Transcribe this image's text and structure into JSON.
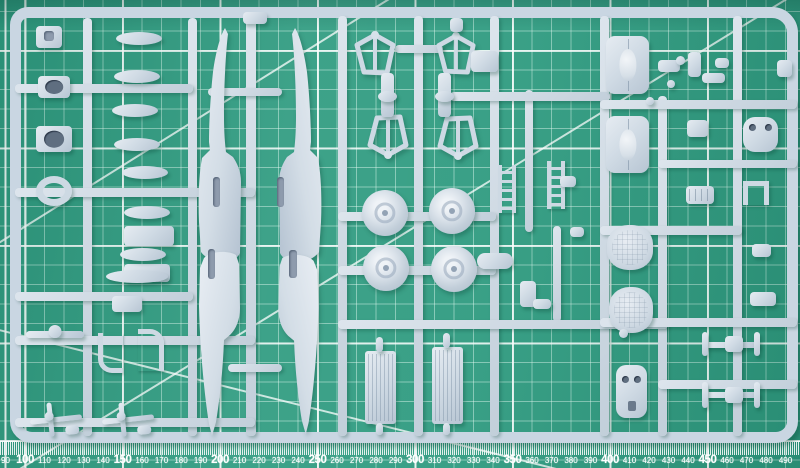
{
  "scene": {
    "subject": "model-kit-sprue-on-cutting-mat",
    "colors": {
      "mat_green": "#2f9b80",
      "grid_line": "#eafcf4",
      "plastic": "#cfdae4",
      "plastic_highlight": "#e8eef4",
      "plastic_shadow": "#9fb0c0",
      "ruler_text": "#ffffff"
    }
  },
  "ruler": {
    "unit": "mm",
    "values": [
      90,
      100,
      110,
      120,
      130,
      140,
      150,
      160,
      170,
      180,
      190,
      200,
      210,
      220,
      230,
      240,
      250,
      260,
      270,
      280,
      290,
      300,
      310,
      320,
      330,
      340,
      350,
      360,
      370,
      380,
      390,
      400,
      410,
      420,
      430,
      440,
      450,
      460,
      470,
      480,
      490
    ],
    "major_step": 50
  },
  "mat": {
    "diagonals": [
      {
        "x": 0,
        "y": 480,
        "len": 940,
        "rot": -31.5
      },
      {
        "x": -8,
        "y": 246,
        "len": 470,
        "rot": -32
      },
      {
        "x": -5,
        "y": 328,
        "len": 580,
        "rot": 14
      }
    ]
  },
  "sprue": {
    "runners_v": [
      [
        83,
        18,
        9,
        418
      ],
      [
        188,
        18,
        9,
        418
      ],
      [
        246,
        14,
        10,
        422
      ],
      [
        338,
        16,
        9,
        420
      ],
      [
        414,
        16,
        9,
        420
      ],
      [
        490,
        16,
        9,
        420
      ],
      [
        600,
        16,
        9,
        420
      ],
      [
        658,
        96,
        9,
        340
      ],
      [
        733,
        16,
        9,
        420
      ],
      [
        525,
        90,
        8,
        142
      ],
      [
        553,
        226,
        8,
        96
      ]
    ],
    "runners_h": [
      [
        15,
        84,
        178,
        9
      ],
      [
        15,
        188,
        240,
        9
      ],
      [
        15,
        292,
        178,
        9
      ],
      [
        15,
        336,
        240,
        9
      ],
      [
        15,
        418,
        240,
        9
      ],
      [
        395,
        45,
        48,
        8
      ],
      [
        450,
        92,
        160,
        9
      ],
      [
        338,
        212,
        158,
        9
      ],
      [
        338,
        266,
        158,
        9
      ],
      [
        338,
        320,
        330,
        9
      ],
      [
        600,
        100,
        197,
        9
      ],
      [
        658,
        160,
        139,
        8
      ],
      [
        600,
        226,
        142,
        9
      ],
      [
        600,
        318,
        197,
        9
      ],
      [
        658,
        380,
        139,
        9
      ],
      [
        208,
        88,
        74,
        8
      ],
      [
        228,
        364,
        54,
        8
      ]
    ],
    "parts": [
      {
        "n": "pilot-seat",
        "t": "slotrect",
        "x": 36,
        "y": 26,
        "w": 26,
        "h": 22
      },
      {
        "n": "ring-mount-1",
        "t": "holes1",
        "x": 38,
        "y": 76,
        "w": 32,
        "h": 22
      },
      {
        "n": "ring-mount-2",
        "t": "holes1",
        "x": 36,
        "y": 126,
        "w": 36,
        "h": 26
      },
      {
        "n": "gun-ring",
        "t": "ring",
        "x": 36,
        "y": 176,
        "w": 36,
        "h": 30
      },
      {
        "n": "block-1",
        "t": "rrect",
        "x": 124,
        "y": 226,
        "w": 50,
        "h": 20
      },
      {
        "n": "block-2",
        "t": "rrect",
        "x": 124,
        "y": 264,
        "w": 46,
        "h": 18
      },
      {
        "n": "anchor-part",
        "t": "rrect",
        "x": 112,
        "y": 296,
        "w": 30,
        "h": 16
      },
      {
        "n": "bomb-1",
        "t": "ellipse",
        "x": 116,
        "y": 32,
        "w": 46,
        "h": 13
      },
      {
        "n": "bomb-2",
        "t": "ellipse",
        "x": 114,
        "y": 70,
        "w": 46,
        "h": 13
      },
      {
        "n": "bomb-3",
        "t": "ellipse",
        "x": 112,
        "y": 104,
        "w": 46,
        "h": 13
      },
      {
        "n": "bomb-4",
        "t": "ellipse",
        "x": 114,
        "y": 138,
        "w": 46,
        "h": 13
      },
      {
        "n": "bomb-5",
        "t": "ellipse",
        "x": 122,
        "y": 166,
        "w": 46,
        "h": 13
      },
      {
        "n": "bomb-6",
        "t": "ellipse",
        "x": 124,
        "y": 206,
        "w": 46,
        "h": 13
      },
      {
        "n": "bomb-7",
        "t": "ellipse",
        "x": 120,
        "y": 248,
        "w": 46,
        "h": 13
      },
      {
        "n": "drop-tank",
        "t": "ellipse",
        "x": 106,
        "y": 270,
        "w": 62,
        "h": 13
      },
      {
        "n": "fuselage-half-tail-up-left",
        "t": "fus",
        "v": "up",
        "x": 197,
        "y": 28,
        "w": 50,
        "h": 235
      },
      {
        "n": "fuselage-half-tail-up-right",
        "t": "fus",
        "v": "up",
        "m": 1,
        "x": 272,
        "y": 28,
        "w": 52,
        "h": 235
      },
      {
        "n": "fuselage-half-tail-down-left",
        "t": "fus",
        "v": "dn",
        "x": 197,
        "y": 250,
        "w": 50,
        "h": 195
      },
      {
        "n": "fuselage-half-tail-down-right",
        "t": "fus",
        "v": "dn",
        "m": 1,
        "x": 271,
        "y": 253,
        "w": 50,
        "h": 190
      },
      {
        "n": "cockpit-slot",
        "t": "slot",
        "x": 213,
        "y": 177,
        "w": 7,
        "h": 30
      },
      {
        "n": "cockpit-slot",
        "t": "slot",
        "x": 277,
        "y": 177,
        "w": 7,
        "h": 30
      },
      {
        "n": "cockpit-slot",
        "t": "slot",
        "x": 208,
        "y": 249,
        "w": 7,
        "h": 30
      },
      {
        "n": "cockpit-slot",
        "t": "slot",
        "x": 289,
        "y": 250,
        "w": 8,
        "h": 28
      },
      {
        "n": "strut-frame",
        "t": "kite",
        "v": "up",
        "x": 353,
        "y": 32,
        "w": 44,
        "h": 44
      },
      {
        "n": "strut-frame",
        "t": "kite",
        "v": "up",
        "x": 435,
        "y": 33,
        "w": 42,
        "h": 42
      },
      {
        "n": "strut-frame",
        "t": "kite",
        "v": "dn",
        "x": 366,
        "y": 114,
        "w": 44,
        "h": 44
      },
      {
        "n": "strut-frame",
        "t": "kite",
        "v": "dn",
        "x": 436,
        "y": 115,
        "w": 44,
        "h": 44
      },
      {
        "n": "oleo-leg",
        "t": "oleo",
        "x": 381,
        "y": 73,
        "w": 13,
        "h": 44
      },
      {
        "n": "oleo-leg",
        "t": "oleo",
        "x": 438,
        "y": 73,
        "w": 13,
        "h": 44
      },
      {
        "n": "wheel",
        "t": "wheel",
        "x": 362,
        "y": 190,
        "w": 46,
        "h": 46
      },
      {
        "n": "wheel",
        "t": "wheel",
        "x": 429,
        "y": 188,
        "w": 46,
        "h": 46
      },
      {
        "n": "wheel",
        "t": "wheel",
        "x": 363,
        "y": 245,
        "w": 46,
        "h": 46
      },
      {
        "n": "wheel",
        "t": "wheel",
        "x": 431,
        "y": 246,
        "w": 46,
        "h": 46
      },
      {
        "n": "boarding-ladder",
        "t": "ladder",
        "x": 498,
        "y": 165,
        "w": 18,
        "h": 48
      },
      {
        "n": "boarding-ladder",
        "t": "ladder",
        "x": 547,
        "y": 161,
        "w": 18,
        "h": 48
      },
      {
        "n": "intake-cap",
        "t": "rrect",
        "x": 471,
        "y": 51,
        "w": 27,
        "h": 21
      },
      {
        "n": "exhaust-fairing",
        "t": "rrect",
        "x": 477,
        "y": 253,
        "w": 36,
        "h": 16,
        "r": 8
      },
      {
        "n": "small-bracket",
        "t": "rrect",
        "x": 520,
        "y": 281,
        "w": 16,
        "h": 26
      },
      {
        "n": "small-bracket",
        "t": "rrect",
        "x": 533,
        "y": 299,
        "w": 18,
        "h": 10
      },
      {
        "n": "small-part",
        "t": "rrect",
        "x": 560,
        "y": 176,
        "w": 16,
        "h": 11
      },
      {
        "n": "small-part",
        "t": "rrect",
        "x": 570,
        "y": 227,
        "w": 14,
        "h": 10
      },
      {
        "n": "cowling-panel",
        "t": "cowl",
        "x": 606,
        "y": 36,
        "w": 43,
        "h": 58
      },
      {
        "n": "cowling-panel",
        "t": "cowl",
        "x": 606,
        "y": 116,
        "w": 43,
        "h": 57
      },
      {
        "n": "small-part",
        "t": "rrect",
        "x": 658,
        "y": 60,
        "w": 22,
        "h": 12
      },
      {
        "n": "small-part",
        "t": "rrect",
        "x": 688,
        "y": 52,
        "w": 13,
        "h": 25
      },
      {
        "n": "small-part",
        "t": "rrect",
        "x": 702,
        "y": 73,
        "w": 23,
        "h": 10
      },
      {
        "n": "small-part",
        "t": "rrect",
        "x": 715,
        "y": 58,
        "w": 14,
        "h": 10
      },
      {
        "n": "small-knob",
        "t": "ball",
        "x": 676,
        "y": 56,
        "w": 9,
        "h": 9
      },
      {
        "n": "small-knob",
        "t": "ball",
        "x": 667,
        "y": 80,
        "w": 8,
        "h": 8
      },
      {
        "n": "small-knob",
        "t": "ball",
        "x": 646,
        "y": 97,
        "w": 8,
        "h": 8
      },
      {
        "n": "edge-part",
        "t": "rrect",
        "x": 777,
        "y": 60,
        "w": 15,
        "h": 17
      },
      {
        "n": "hatch-part",
        "t": "rrect",
        "x": 687,
        "y": 120,
        "w": 21,
        "h": 17
      },
      {
        "n": "cowl-front",
        "t": "holes2",
        "x": 743,
        "y": 117,
        "w": 35,
        "h": 35,
        "r": 12
      },
      {
        "n": "engine-block",
        "t": "engine",
        "x": 686,
        "y": 186,
        "w": 28,
        "h": 18
      },
      {
        "n": "u-bracket",
        "t": "ubracket",
        "x": 743,
        "y": 181,
        "w": 26,
        "h": 24
      },
      {
        "n": "small-part",
        "t": "rrect",
        "x": 752,
        "y": 244,
        "w": 19,
        "h": 13
      },
      {
        "n": "small-part",
        "t": "rrect",
        "x": 750,
        "y": 292,
        "w": 26,
        "h": 14
      },
      {
        "n": "seat-cushion",
        "t": "cushion",
        "x": 607,
        "y": 225,
        "w": 46,
        "h": 45
      },
      {
        "n": "seat-cushion",
        "t": "cushion",
        "x": 609,
        "y": 287,
        "w": 44,
        "h": 46
      },
      {
        "n": "small-knob",
        "t": "ball",
        "x": 619,
        "y": 329,
        "w": 9,
        "h": 9
      },
      {
        "n": "firewall",
        "t": "holes2",
        "x": 616,
        "y": 365,
        "w": 31,
        "h": 53,
        "r": 10,
        "notch": 1
      },
      {
        "n": "wing-strut-assembly",
        "t": "hstrut",
        "x": 702,
        "y": 332,
        "w": 58,
        "h": 24
      },
      {
        "n": "wing-strut-assembly",
        "t": "hstrut",
        "x": 702,
        "y": 382,
        "w": 58,
        "h": 26
      },
      {
        "n": "radiator-core",
        "t": "radiator",
        "x": 365,
        "y": 351,
        "w": 31,
        "h": 73
      },
      {
        "n": "radiator-core",
        "t": "radiator",
        "x": 432,
        "y": 347,
        "w": 31,
        "h": 77
      },
      {
        "n": "sprue-gate",
        "t": "rrect",
        "x": 376,
        "y": 337,
        "w": 7,
        "h": 15
      },
      {
        "n": "sprue-gate",
        "t": "rrect",
        "x": 443,
        "y": 333,
        "w": 7,
        "h": 15
      },
      {
        "n": "sprue-gate",
        "t": "rrect",
        "x": 376,
        "y": 423,
        "w": 7,
        "h": 12
      },
      {
        "n": "sprue-gate",
        "t": "rrect",
        "x": 443,
        "y": 423,
        "w": 7,
        "h": 12
      },
      {
        "n": "propeller-blade-pair",
        "t": "prop",
        "x": 26,
        "y": 327,
        "w": 58,
        "h": 13
      },
      {
        "n": "exhaust-pipe",
        "t": "pipeL",
        "x": 98,
        "y": 333,
        "w": 25,
        "h": 40
      },
      {
        "n": "exhaust-pipe",
        "t": "pipeR",
        "x": 138,
        "y": 329,
        "w": 26,
        "h": 42
      },
      {
        "n": "machine-gun",
        "t": "gun",
        "x": 30,
        "y": 400,
        "w": 52,
        "h": 38
      },
      {
        "n": "machine-gun",
        "t": "gun",
        "x": 102,
        "y": 400,
        "w": 52,
        "h": 38
      },
      {
        "n": "sprue-stub",
        "t": "rrect",
        "x": 243,
        "y": 12,
        "w": 24,
        "h": 12
      },
      {
        "n": "sprue-stub",
        "t": "rrect",
        "x": 450,
        "y": 18,
        "w": 13,
        "h": 14
      }
    ]
  }
}
